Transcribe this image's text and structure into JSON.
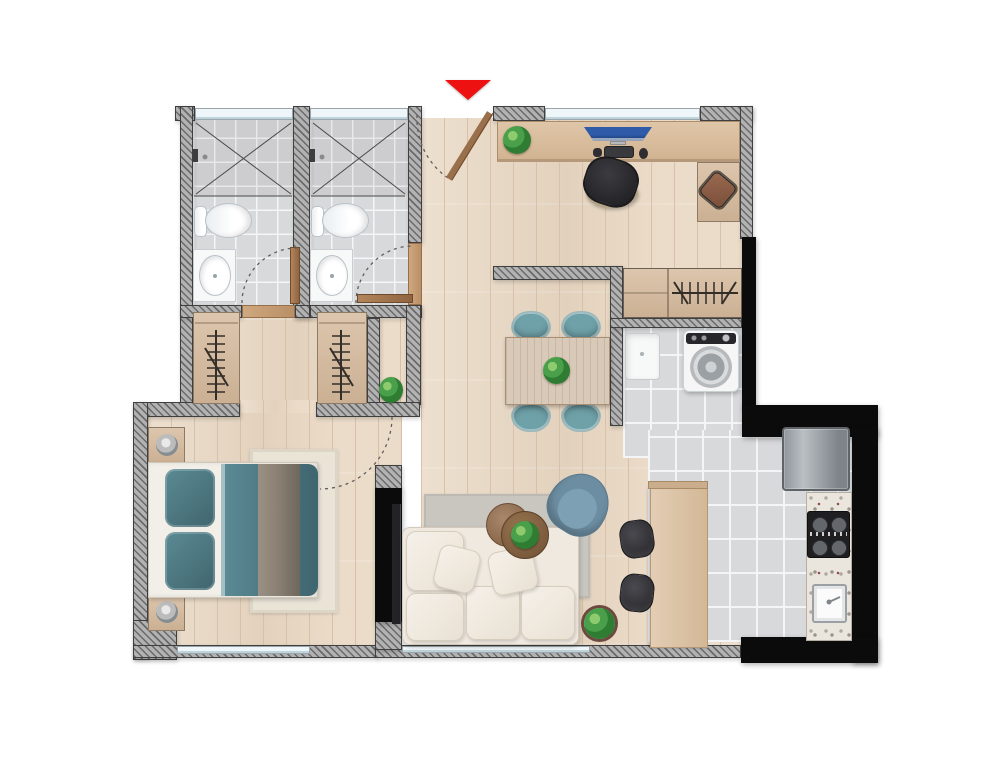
{
  "title": "apartment-floor-plan",
  "entrance": {
    "marker": "red-triangle-down"
  },
  "colors": {
    "wood": "#e9d8c3",
    "wood_line": "#d8c1a8",
    "tile": "#d8d9db",
    "grout": "#f4f5f6",
    "wall": "#b2b2b2",
    "wall_border": "#3f3f3f",
    "black": "#0b0b0b",
    "win": "#eef6f9",
    "teal": "#6fa1a9",
    "duvet": "#4d7983",
    "throw_blanket": "#897f73",
    "sofa": "#efe9e0",
    "rug_gray": "#c9c6c0",
    "rug_cream": "#eae4d7",
    "armchair": "#6d8ea2",
    "green": "#3f9143",
    "red": "#ee1111",
    "dark": "#2b2b2f",
    "granite": "#eae6de",
    "fridge": "#9ba1a5"
  },
  "rooms": [
    {
      "name": "bathroom-1",
      "furniture": [
        "shower",
        "toilet",
        "sink",
        "swing-door"
      ]
    },
    {
      "name": "bathroom-2",
      "furniture": [
        "shower",
        "toilet",
        "sink",
        "swing-door"
      ]
    },
    {
      "name": "hall-closet-1",
      "furniture": [
        "hanging-rail"
      ]
    },
    {
      "name": "hall-closet-2",
      "furniture": [
        "hanging-rail"
      ]
    },
    {
      "name": "bedroom",
      "furniture": [
        "double-bed",
        "two-pillows",
        "duvet",
        "throw-blanket",
        "nightstand-left",
        "nightstand-right",
        "two-lamps",
        "cream-rug",
        "tv-panel",
        "swing-door"
      ]
    },
    {
      "name": "living-room",
      "furniture": [
        "sofa",
        "chaise",
        "throw-pillows",
        "gray-rug",
        "nested-coffee-tables",
        "armchair",
        "floor-plant"
      ]
    },
    {
      "name": "dining-area",
      "furniture": [
        "table",
        "four-chairs",
        "centerpiece-plant"
      ]
    },
    {
      "name": "study-area",
      "furniture": [
        "desk",
        "monitor",
        "keyboard",
        "mouse",
        "office-chair",
        "desk-plant",
        "side-table",
        "stool"
      ]
    },
    {
      "name": "wardrobe-closet",
      "furniture": [
        "cabinet",
        "hanging-rail"
      ]
    },
    {
      "name": "laundry",
      "furniture": [
        "utility-sink",
        "washing-machine"
      ]
    },
    {
      "name": "kitchen",
      "furniture": [
        "refrigerator",
        "granite-counter",
        "cooktop",
        "sink",
        "bar-counter",
        "two-bar-stools"
      ]
    }
  ]
}
